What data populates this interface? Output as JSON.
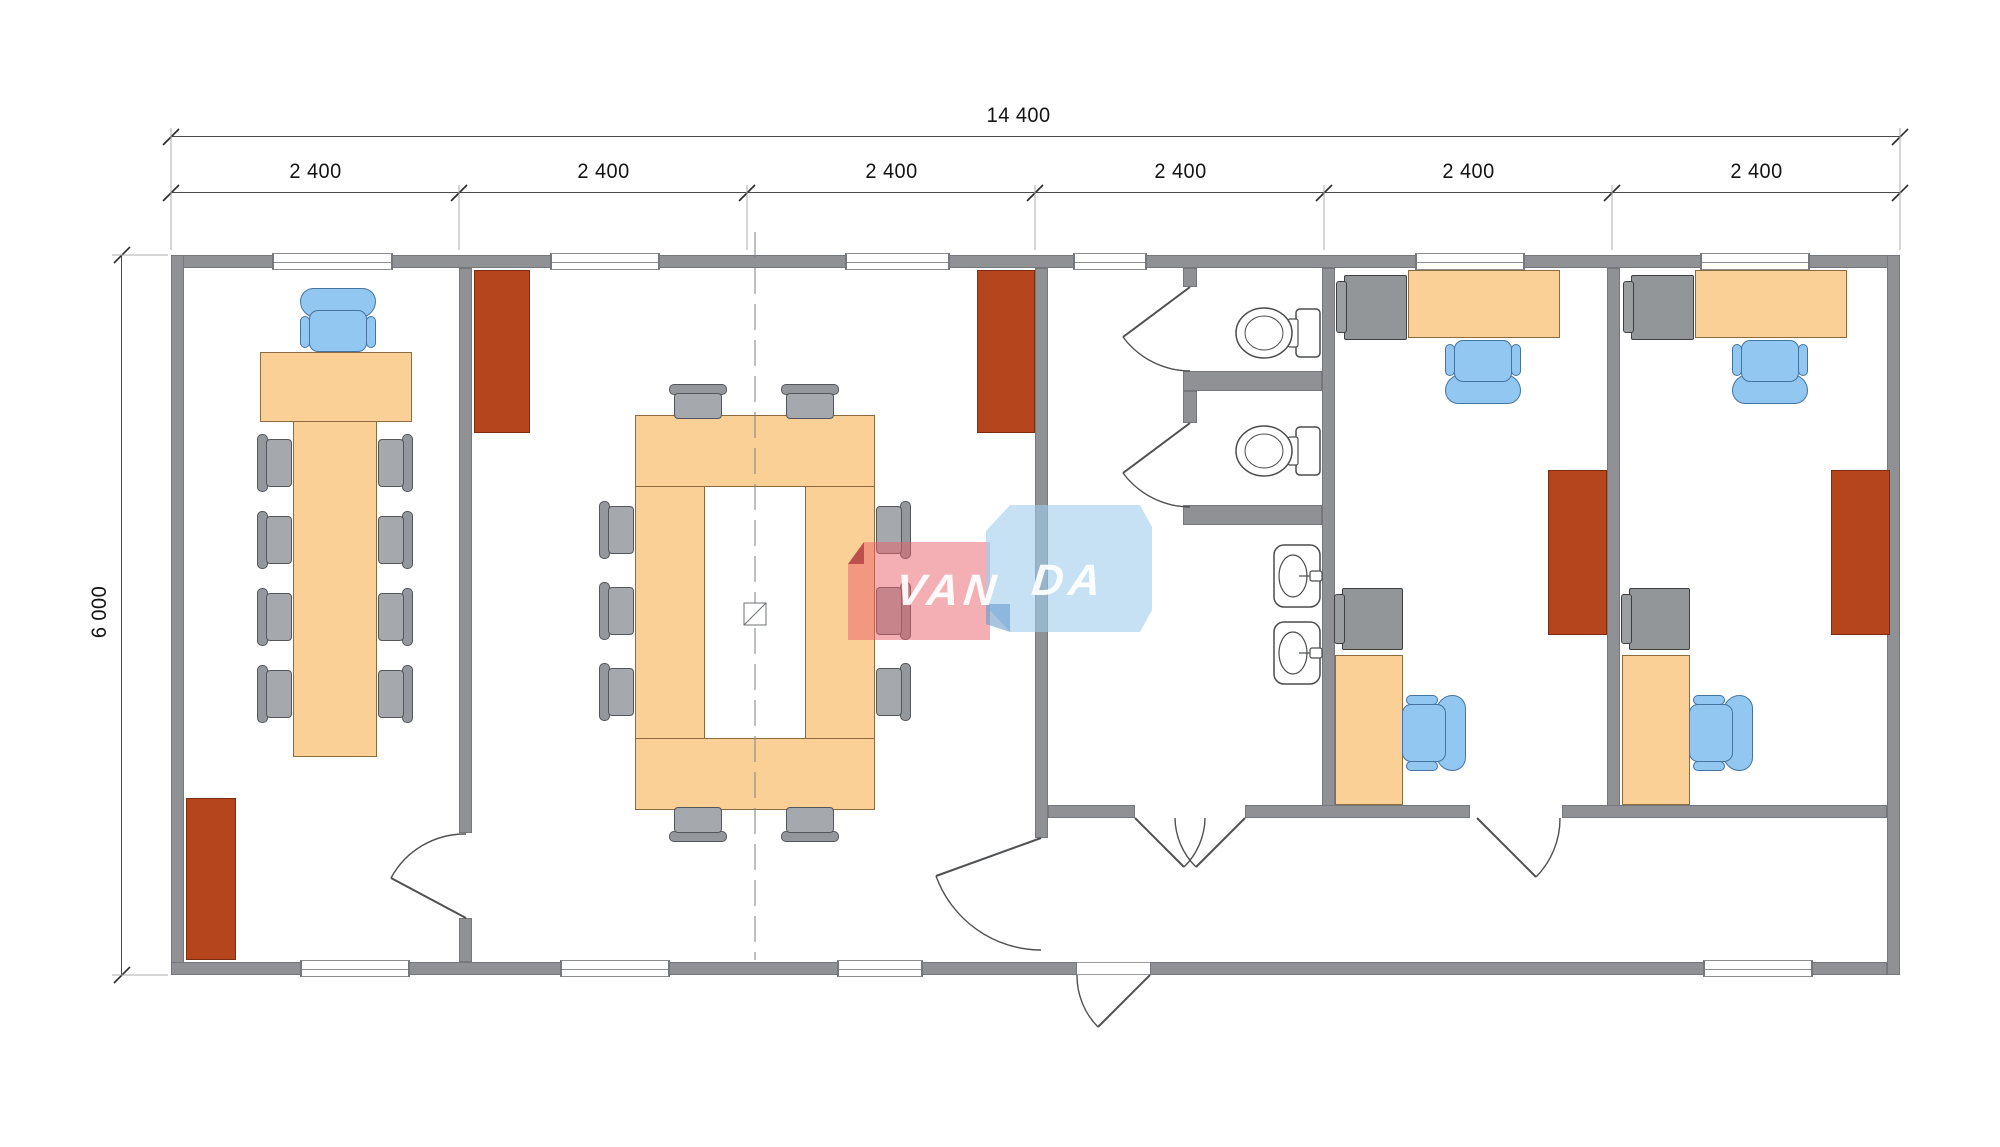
{
  "dimensions": {
    "total_width": "14 400",
    "total_height": "6 000",
    "modules": [
      "2 400",
      "2 400",
      "2 400",
      "2 400",
      "2 400",
      "2 400"
    ]
  },
  "watermark": {
    "left": "VAN",
    "right": "DA"
  },
  "colors": {
    "wall": "#8f9194",
    "furniture_wood": "#fad096",
    "chair_gray": "#9fa2a6",
    "chair_blue": "#92c7f2",
    "wardrobe_red": "#b5451c",
    "watermark_red": "#e95f6a",
    "watermark_blue": "#a0cded"
  }
}
